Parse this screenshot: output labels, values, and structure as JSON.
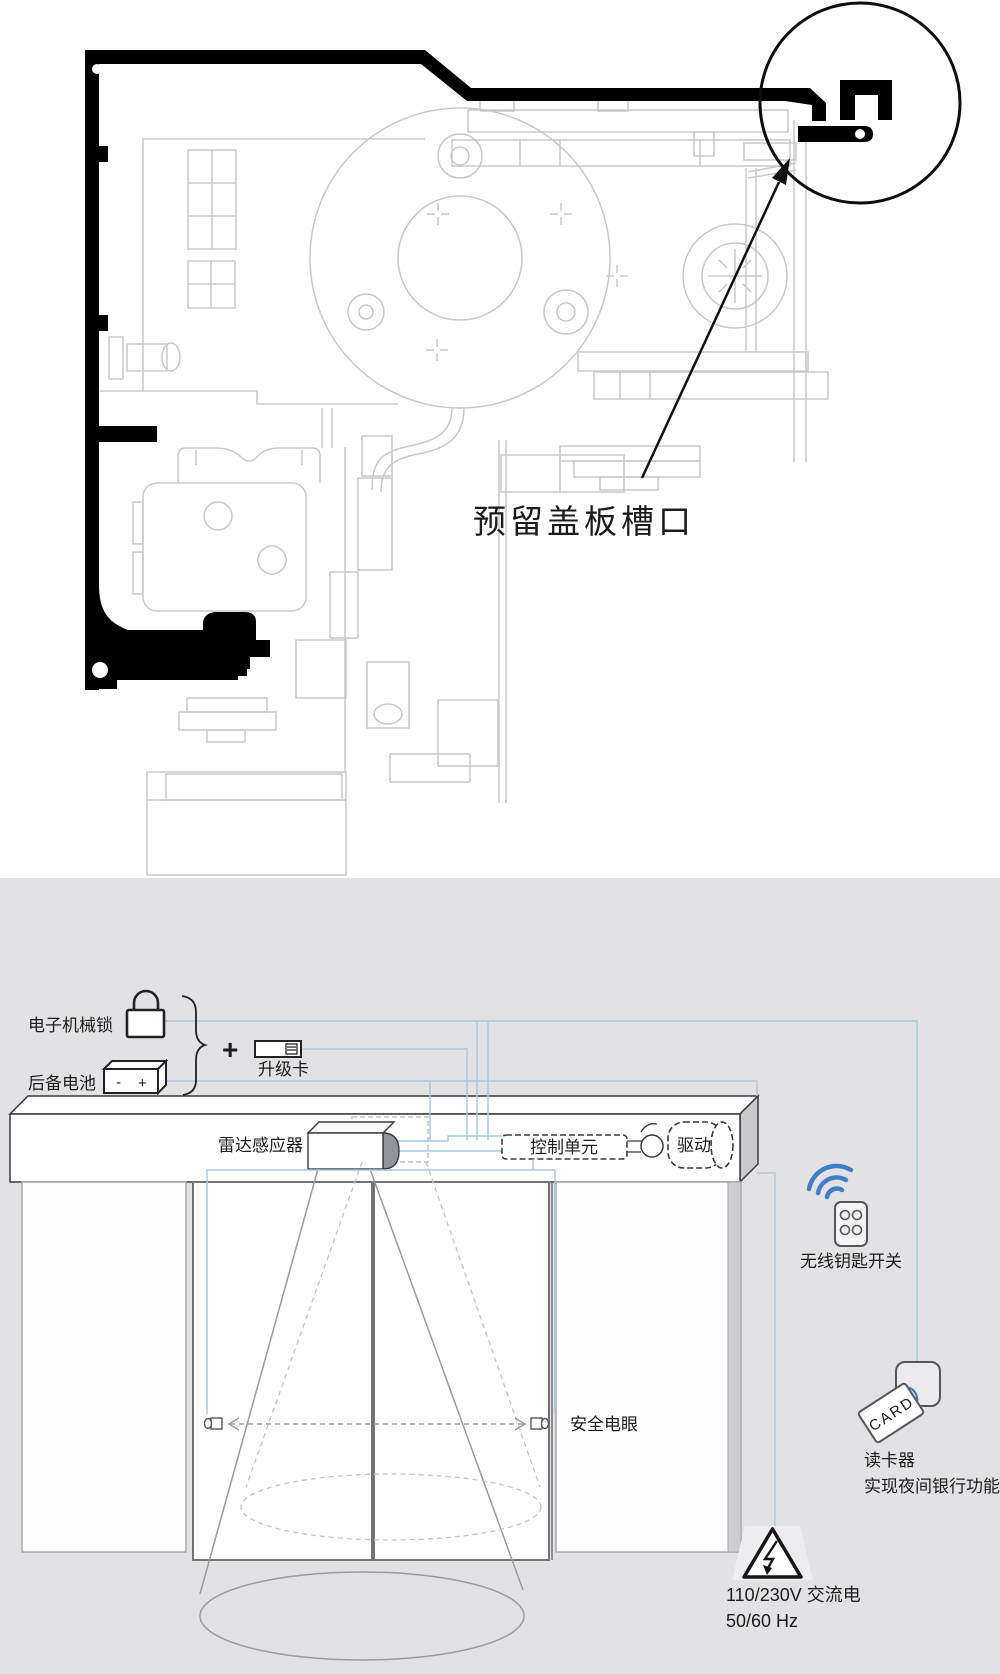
{
  "top_diagram": {
    "callout_label": "预留盖板槽口"
  },
  "bottom_diagram": {
    "title": "承载架可以从驱动下方穿过",
    "components": {
      "lock_label": "电子机械锁",
      "battery_label": "后备电池",
      "battery_minus": "-",
      "battery_plus": "+",
      "plus_sign": "+",
      "upgrade_card_label": "升级卡",
      "radar_label": "雷达感应器",
      "control_unit_label": "控制单元",
      "drive_label": "驱动",
      "wireless_key_label": "无线钥匙开关",
      "photocell_label": "安全电眼",
      "card_reader_label": "读卡器",
      "card_reader_function_label": "实现夜间银行功能",
      "card_text": "CARD",
      "power_voltage": "110/230V 交流电",
      "power_frequency": "50/60 Hz"
    },
    "colors": {
      "background": "#e2e2e4",
      "wire": "#a5c8e2",
      "wireless_blue": "#3d7ec6"
    }
  }
}
